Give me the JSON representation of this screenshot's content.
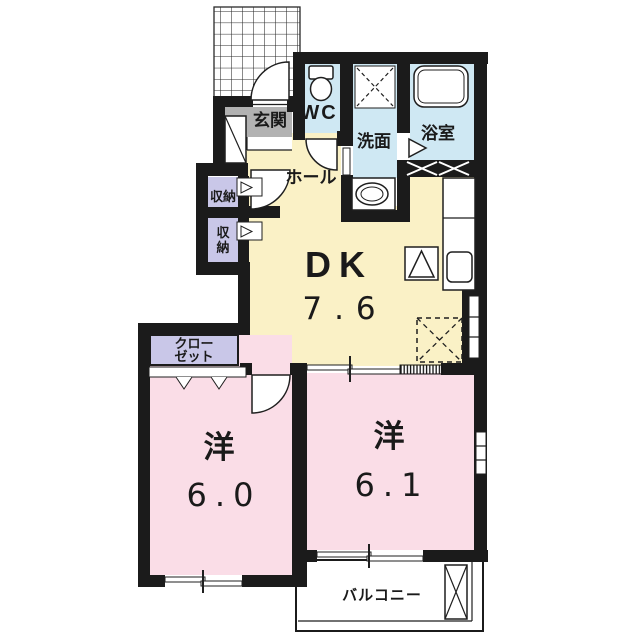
{
  "colors": {
    "wall": "#1b1b1b",
    "dk_floor": "#faf1c6",
    "room_floor": "#fadde7",
    "wet_floor": "#cfe8f3",
    "storage_floor": "#c9c7e8",
    "genkan_floor": "#b2b2b2",
    "balcony_floor": "#ffffff",
    "line": "#1f1f1f"
  },
  "rooms": {
    "genkan": {
      "label": "玄関"
    },
    "wc": {
      "label": "WC"
    },
    "senmen": {
      "label": "洗面"
    },
    "bath": {
      "label": "浴室"
    },
    "hall": {
      "label": "ホール"
    },
    "storage_a": {
      "label": "収納"
    },
    "storage_b": {
      "char1": "収",
      "char2": "納"
    },
    "dk": {
      "label": "DK",
      "size": "7.6"
    },
    "closet": {
      "line1": "クロー",
      "line2": "ゼット"
    },
    "west_a": {
      "label": "洋",
      "size": "6.0"
    },
    "west_b": {
      "label": "洋",
      "size": "6.1"
    },
    "balcony": {
      "label": "バルコニー"
    }
  }
}
